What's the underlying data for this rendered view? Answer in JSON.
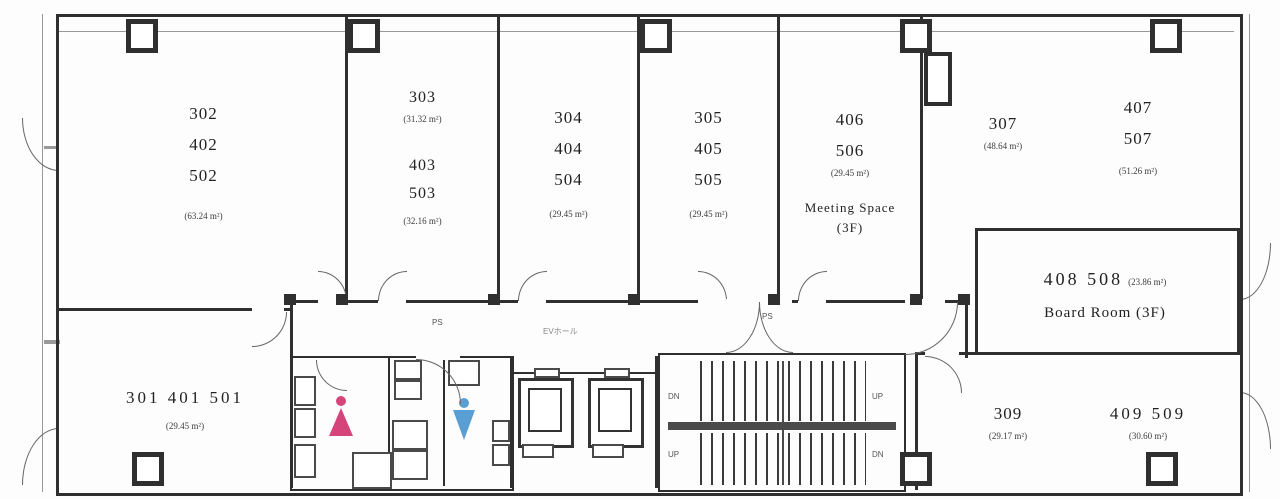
{
  "rooms": {
    "r302": {
      "n1": "302",
      "n2": "402",
      "n3": "502",
      "area": "(63.24 m²)"
    },
    "r303": {
      "n1": "303",
      "area1": "(31.32 m²)",
      "n2": "403",
      "n3": "503",
      "area2": "(32.16 m²)"
    },
    "r304": {
      "n1": "304",
      "n2": "404",
      "n3": "504",
      "area": "(29.45 m²)"
    },
    "r305": {
      "n1": "305",
      "n2": "405",
      "n3": "505",
      "area": "(29.45 m²)"
    },
    "r406": {
      "n1": "406",
      "n2": "506",
      "area": "(29.45 m²)",
      "label": "Meeting Space",
      "floor": "(3F)"
    },
    "r307": {
      "n1": "307",
      "area": "(48.64 m²)"
    },
    "r407": {
      "n1": "407",
      "n2": "507",
      "area": "(51.26 m²)"
    },
    "r408": {
      "title": "408 508",
      "area": "(23.86 m²)",
      "label": "Board Room (3F)"
    },
    "r301": {
      "title": "301  401 501",
      "area": "(29.45 m²)"
    },
    "r309": {
      "n1": "309",
      "area": "(29.17 m²)"
    },
    "r409": {
      "title": "409 509",
      "area": "(30.60 m²)"
    }
  },
  "core": {
    "ev_hall": "EVホール",
    "ps_left": "PS",
    "ps_right": "PS",
    "stair_dn_top": "DN",
    "stair_up_top": "UP",
    "stair_up_bottom": "UP",
    "stair_dn_bottom": "DN"
  },
  "colors": {
    "line": "#2f2f2f",
    "women_icon": "#d6447c",
    "men_icon": "#5a9fd4"
  }
}
